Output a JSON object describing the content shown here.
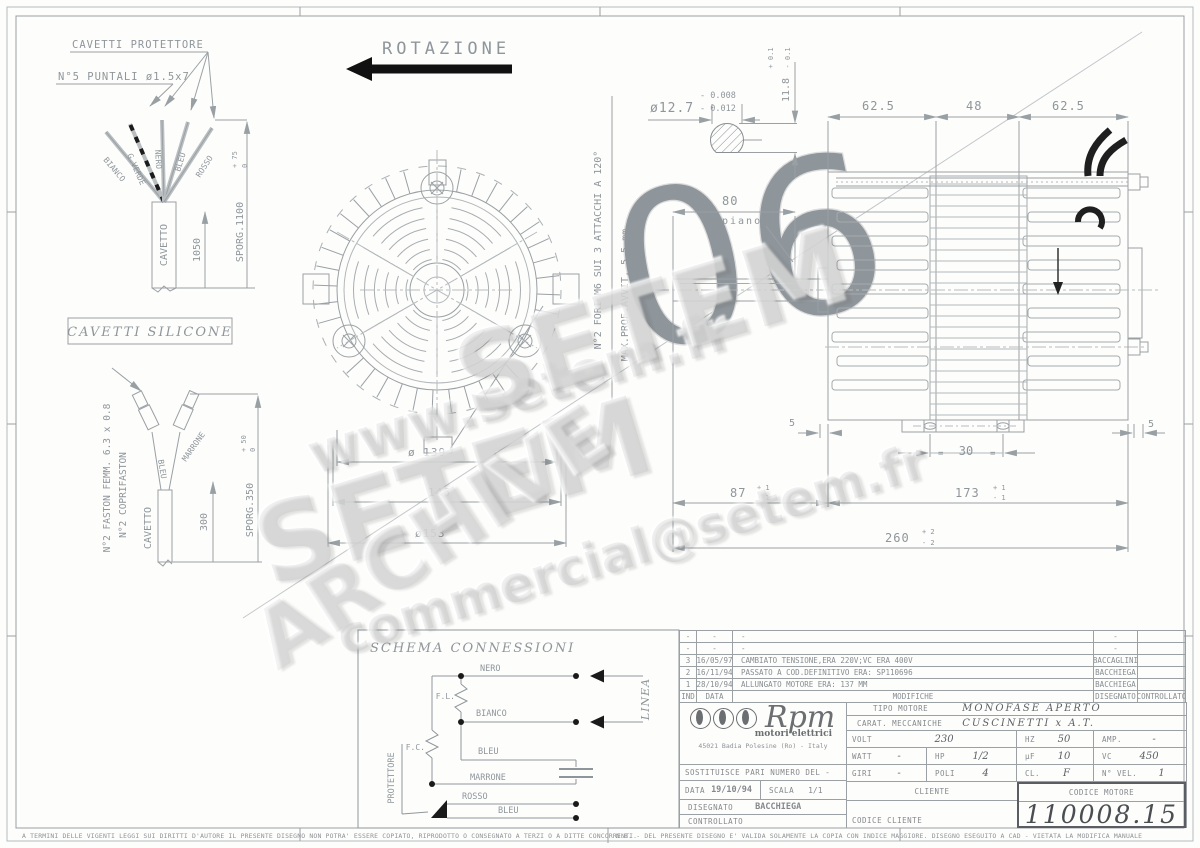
{
  "colors": {
    "line": "#9aa0a4",
    "ink": "#1c1c1c",
    "text": "#8f969b",
    "watermark": "#cfcfcf"
  },
  "watermarks": {
    "big1": "SETEM",
    "big2": "SETEM",
    "url": "www.setem.fr",
    "email": "commercial@setem.fr",
    "archive": "ARCHIVE",
    "ghost_digits": "06"
  },
  "rotation": {
    "label": "ROTAZIONE"
  },
  "cavetti_protettore": {
    "title": "CAVETTI PROTETTORE",
    "puntali_note": "N°5 PUNTALI ø1.5x7",
    "wire_labels": [
      "BIANCO",
      "G.VERDE",
      "NERO",
      "BLEU",
      "ROSSO"
    ],
    "cable_label": "CAVETTO",
    "dim_length": "1050",
    "sporg_label": "SPORG.1100",
    "sporg_plus": "+ 75",
    "sporg_minus": "0"
  },
  "cavetti_silicone": {
    "title": "CAVETTI SILICONE",
    "faston_note": "N°2 FASTON FEMM. 6.3 x 0.8",
    "coprifaston_note": "N°2 COPRIFASTON",
    "wire_left": "BLEU",
    "wire_right": "MARRONE",
    "cable_label": "CAVETTO",
    "dim_length": "300",
    "sporg_label": "SPORG.350",
    "sporg_plus": "+ 50",
    "sporg_minus": "0"
  },
  "front_view": {
    "dim_fan": "ø 139",
    "dim_body": "146",
    "dim_outer": "ø153",
    "holes_note": "N°2 FORI M6 SUI 3 ATTACCHI A 120°",
    "depth_note": "MAX.PROF.AVVIT. 5.5 mm"
  },
  "shaft_detail": {
    "dim": "ø12.7",
    "tol_top": "- 0.008",
    "tol_bot": "- 0.012",
    "flat_dim": "11.8",
    "flat_plus": "+ 0.1",
    "flat_minus": "- 0.1"
  },
  "side_view": {
    "dim_62_left": "62.5",
    "dim_48": "48",
    "dim_62_right": "62.5",
    "dim_80": "80",
    "piano": "piano",
    "dim_30": "30",
    "eq_left": "=",
    "eq_right": "=",
    "dim_87": "87",
    "dim_87_plus": "+ 1",
    "dim_87_minus": "- 1",
    "dim_173": "173",
    "dim_173_plus": "+ 1",
    "dim_173_minus": "- 1",
    "dim_260": "260",
    "dim_260_plus": "+ 2",
    "dim_260_minus": "- 2",
    "dim_5_left": "5",
    "dim_5_right": "5"
  },
  "schema": {
    "title": "SCHEMA CONNESSIONI",
    "nero": "NERO",
    "bianco": "BIANCO",
    "bleu_top": "BLEU",
    "marrone": "MARRONE",
    "rosso": "ROSSO",
    "bleu_bottom": "BLEU",
    "fl": "F.L.",
    "fc": "F.C.",
    "linea": "LINEA",
    "protettore": "PROTETTORE"
  },
  "revisions": {
    "headers": [
      "IND",
      "DATA",
      "MODIFICHE",
      "DISEGNATO",
      "CONTROLLATO"
    ],
    "rows": [
      {
        "ind": "-",
        "date": "-",
        "desc": "-",
        "by": "-",
        "chk": ""
      },
      {
        "ind": "-",
        "date": "-",
        "desc": "-",
        "by": "-",
        "chk": ""
      },
      {
        "ind": "3",
        "date": "16/05/97",
        "desc": "CAMBIATO TENSIONE,ERA 220V;VC ERA 400V",
        "by": "BACCAGLINI",
        "chk": ""
      },
      {
        "ind": "2",
        "date": "16/11/94",
        "desc": "PASSATO A COD.DEFINITIVO ERA: SP110696",
        "by": "BACCHIEGA",
        "chk": ""
      },
      {
        "ind": "1",
        "date": "28/10/94",
        "desc": "ALLUNGATO MOTORE ERA: 137 MM",
        "by": "BACCHIEGA",
        "chk": ""
      }
    ]
  },
  "titleblock": {
    "brand": "Rpm",
    "brand_sub": "motori elettrici",
    "address": "45021 Badia Polesine (Ro) - Italy",
    "sostituisce_label": "SOSTITUISCE PARI NUMERO DEL",
    "sostituisce_value": "-",
    "data_label": "DATA",
    "data_value": "19/10/94",
    "scala_label": "SCALA",
    "scala_value": "1/1",
    "disegnato_label": "DISEGNATO",
    "disegnato_value": "BACCHIEGA",
    "controllato_label": "CONTROLLATO",
    "tipo_label": "TIPO MOTORE",
    "tipo_value": "MONOFASE APERTO",
    "carat_label": "CARAT. MECCANICHE",
    "carat_value": "CUSCINETTI x A.T.",
    "volt_label": "VOLT",
    "volt_value": "230",
    "hz_label": "HZ",
    "hz_value": "50",
    "amp_label": "AMP.",
    "amp_value": "-",
    "watt_label": "WATT",
    "watt_value": "-",
    "hp_label": "HP",
    "hp_value": "1/2",
    "uf_label": "µF",
    "uf_value": "10",
    "vc_label": "VC",
    "vc_value": "450",
    "giri_label": "GIRI",
    "giri_value": "-",
    "poli_label": "POLI",
    "poli_value": "4",
    "cl_label": "CL.",
    "cl_value": "F",
    "nvel_label": "N° VEL.",
    "nvel_value": "1",
    "cliente_label": "CLIENTE",
    "codice_motore_label": "CODICE MOTORE",
    "codice_motore_value": "110008.15",
    "codice_cliente_label": "CODICE CLIENTE"
  },
  "footer": {
    "left": "A TERMINI DELLE VIGENTI LEGGI SUI DIRITTI D'AUTORE IL PRESENTE DISEGNO NON POTRA' ESSERE COPIATO, RIPRODOTTO O CONSEGNATO A TERZI O A DITTE CONCORRENTI.",
    "right": "N.B. - DEL PRESENTE DISEGNO E' VALIDA SOLAMENTE LA COPIA CON INDICE MAGGIORE.      DISEGNO ESEGUITO A CAD - VIETATA LA MODIFICA MANUALE"
  }
}
